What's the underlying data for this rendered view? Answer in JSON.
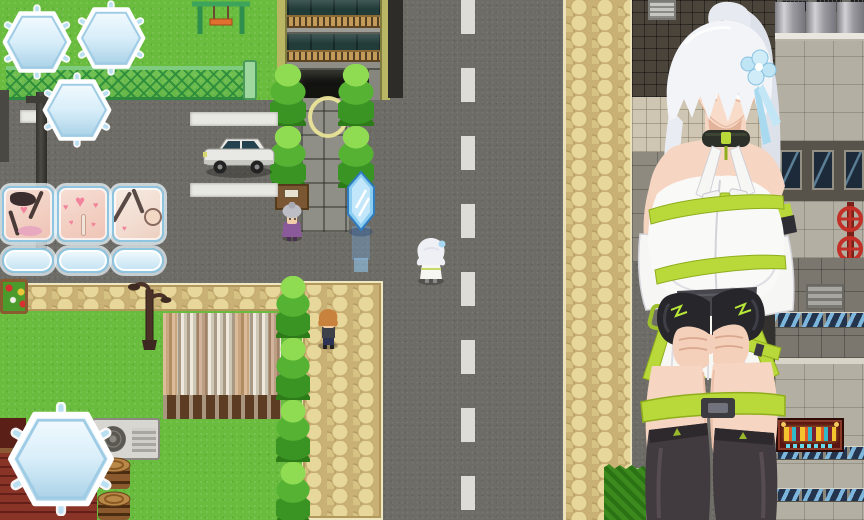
{
  "hud": {
    "top_badges": [
      {
        "name": "flags",
        "icon": "flag-icon",
        "value": "0"
      },
      {
        "name": "hearts",
        "icon": "heart-icon",
        "value": "80"
      },
      {
        "name": "money",
        "icon": "money-icon",
        "value": "20"
      }
    ],
    "scene_cards": [
      {
        "name": "scene-slot-1",
        "count": "0"
      },
      {
        "name": "scene-slot-2",
        "count": "0"
      },
      {
        "name": "scene-slot-3",
        "count": "0"
      }
    ],
    "deadline": {
      "label": "残り期限",
      "value": "13"
    }
  },
  "map": {
    "entities": [
      "apartment-building",
      "entrance-highlight-ring",
      "save-crystal",
      "parked-car",
      "swing-set",
      "park-fence",
      "utility-pole",
      "street-lamp",
      "flower-bed",
      "corrugated-shack-wall",
      "red-roof-house",
      "air-conditioner",
      "barrel-stack",
      "conifer-trees",
      "cobblestone-sidewalk",
      "asphalt-road",
      "road-center-line",
      "industrial-building",
      "fuel-silos",
      "red-valve-wheels",
      "neon-sign",
      "office-building",
      "hedge"
    ],
    "npcs": [
      {
        "name": "old-lady-npc"
      },
      {
        "name": "white-haired-player"
      },
      {
        "name": "boy-npc"
      }
    ],
    "overlay_character": {
      "name": "giant-white-haired-girl",
      "outfit": "white-dress-green-straps-black-stockings"
    }
  },
  "colors": {
    "hud_frame": "#8ec6e2",
    "hud_fill": "#dceef8",
    "grass": "#6abc3e",
    "asphalt": "#6e6c66",
    "cobblestone": "#cdb87c",
    "strap_green": "#b9d83a",
    "crystal_blue": "#8cd0f4",
    "valve_red": "#c23028"
  }
}
